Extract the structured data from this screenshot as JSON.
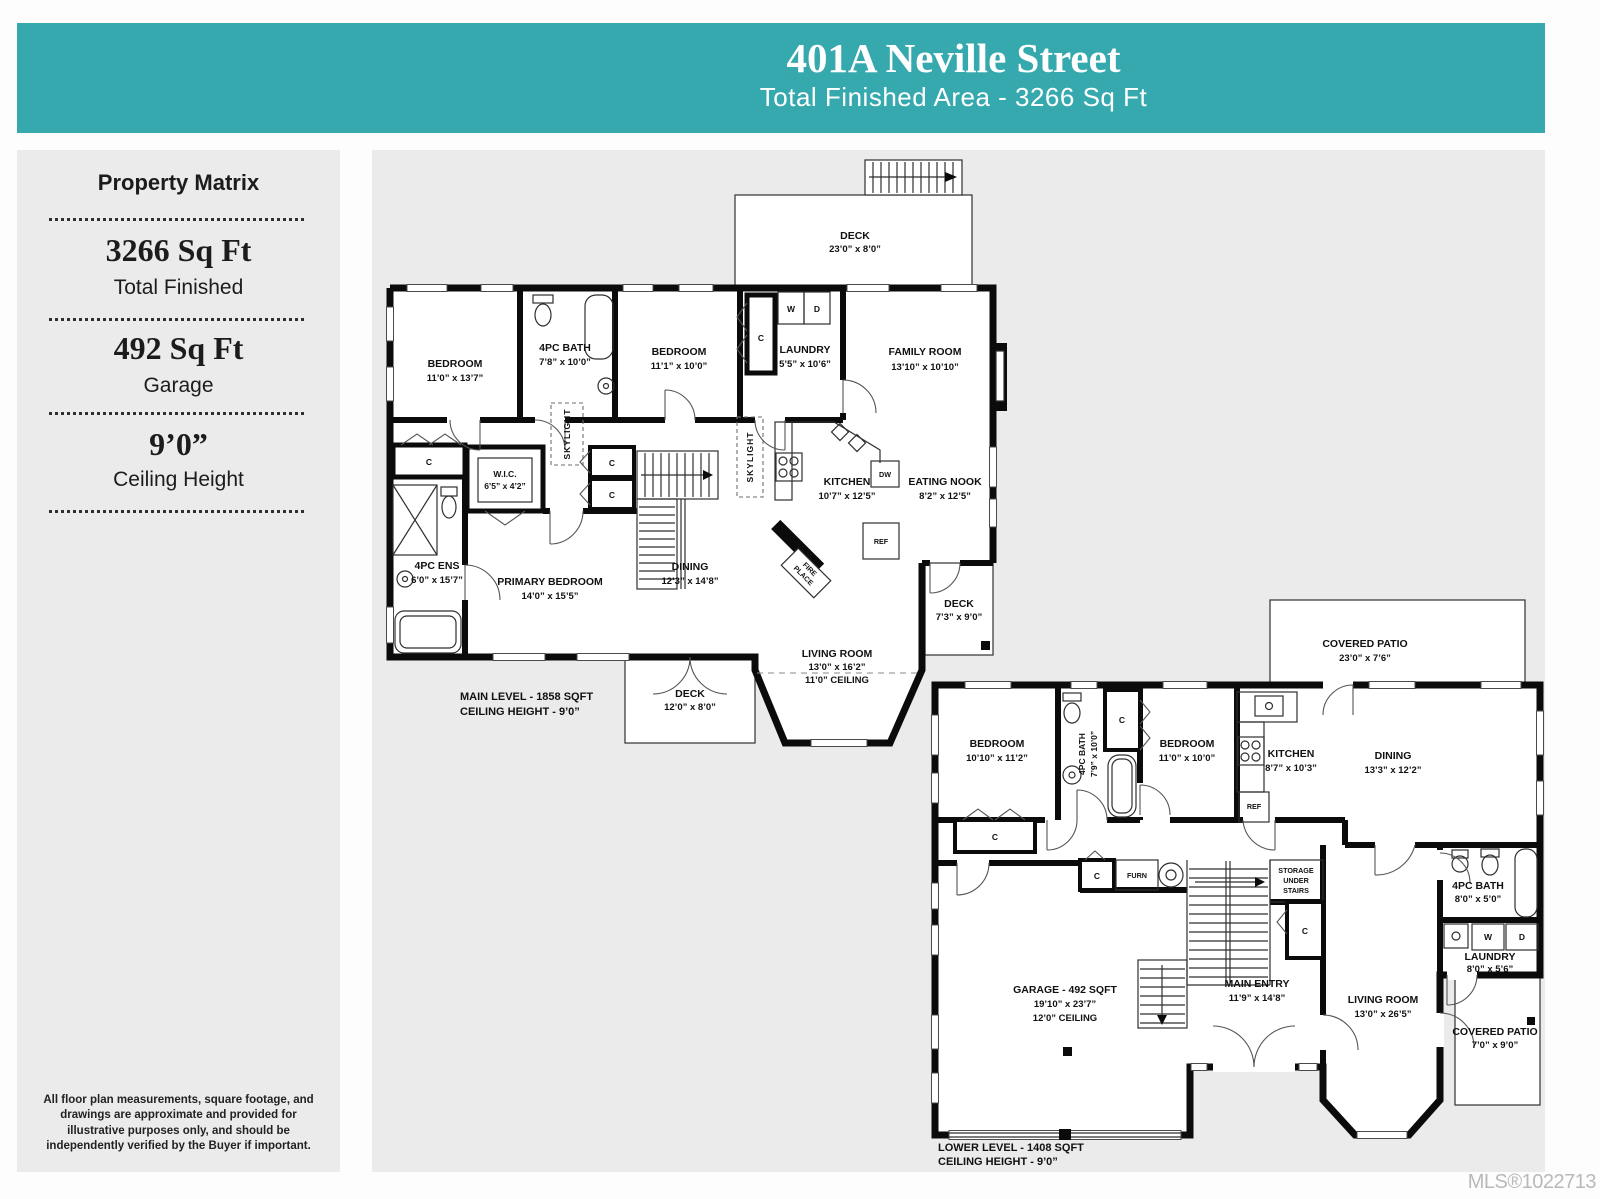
{
  "colors": {
    "header_bg": "#35a9ad",
    "panel_bg": "#ebebeb",
    "wall": "#0b0b0b"
  },
  "header": {
    "title": "401A Neville Street",
    "subtitle": "Total Finished Area - 3266 Sq Ft"
  },
  "sidebar": {
    "title": "Property Matrix",
    "stats": [
      {
        "value": "3266 Sq Ft",
        "label": "Total Finished"
      },
      {
        "value": "492 Sq Ft",
        "label": "Garage"
      },
      {
        "value": "9’0”",
        "label": "Ceiling Height"
      }
    ],
    "disclaimer": "All floor plan measurements, square footage, and drawings are approximate and provided for illustrative purposes only, and should be independently verified by the Buyer if important."
  },
  "tags": {
    "c": "C",
    "w": "W",
    "d": "D",
    "dw": "DW",
    "ref": "REF",
    "furn": "FURN",
    "skylight": "SKYLIGHT",
    "fire": "FIRE",
    "place": "PLACE"
  },
  "main_level": {
    "footer1": "MAIN LEVEL - 1858 SQFT",
    "footer2": "CEILING HEIGHT - 9’0”",
    "rooms": {
      "bedroom1": {
        "name": "BEDROOM",
        "dims": "11’0” x 13’7”"
      },
      "bath": {
        "name": "4PC BATH",
        "dims": "7’8” x 10’0”"
      },
      "bedroom2": {
        "name": "BEDROOM",
        "dims": "11’1” x 10’0”"
      },
      "laundry": {
        "name": "LAUNDRY",
        "dims": "5’5” x 10’6”"
      },
      "family": {
        "name": "FAMILY ROOM",
        "dims": "13’10” x 10’10”"
      },
      "deck_top": {
        "name": "DECK",
        "dims": "23’0” x 8’0”"
      },
      "kitchen": {
        "name": "KITCHEN",
        "dims": "10’7” x 12’5”"
      },
      "nook": {
        "name": "EATING NOOK",
        "dims": "8’2” x 12’5”"
      },
      "wic": {
        "name": "W.I.C.",
        "dims": "6’5” x 4’2”"
      },
      "ens": {
        "name": "4PC ENS",
        "dims": "6’0” x 15’7”"
      },
      "primary": {
        "name": "PRIMARY BEDROOM",
        "dims": "14’0” x 15’5”"
      },
      "dining": {
        "name": "DINING",
        "dims": "12’3” x 14’8”"
      },
      "living": {
        "name": "LIVING ROOM",
        "dims": "13’0” x 16’2”",
        "extra": "11’0” CEILING"
      },
      "deck_right": {
        "name": "DECK",
        "dims": "7’3” x 9’0”"
      },
      "deck_bottom": {
        "name": "DECK",
        "dims": "12’0” x 8’0”"
      }
    }
  },
  "lower_level": {
    "footer1": "LOWER LEVEL - 1408 SQFT",
    "footer2": "CEILING HEIGHT - 9’0”",
    "rooms": {
      "patio_top": {
        "name": "COVERED PATIO",
        "dims": "23’0” x 7’6”"
      },
      "bedroom1": {
        "name": "BEDROOM",
        "dims": "10’10” x 11’2”"
      },
      "bath": {
        "name": "4PC BATH",
        "dims": "7’9” x 10’0”"
      },
      "bedroom2": {
        "name": "BEDROOM",
        "dims": "11’0” x 10’0”"
      },
      "kitchen": {
        "name": "KITCHEN",
        "dims": "8’7” x 10’3”"
      },
      "dining": {
        "name": "DINING",
        "dims": "13’3” x 12’2”"
      },
      "storage": [
        "STORAGE",
        "UNDER",
        "STAIRS"
      ],
      "entry": {
        "name": "MAIN ENTRY",
        "dims": "11’9” x 14’8”"
      },
      "garage": {
        "name": "GARAGE - 492 SQFT",
        "dims": "19’10” x 23’7”",
        "extra": "12’0” CEILING"
      },
      "living": {
        "name": "LIVING ROOM",
        "dims": "13’0” x 26’5”"
      },
      "bath2": {
        "name": "4PC BATH",
        "dims": "8’0” x 5’0”"
      },
      "laundry": {
        "name": "LAUNDRY",
        "dims": "8’0” x 5’6”"
      },
      "patio_br": {
        "name": "COVERED PATIO",
        "dims": "7’0” x 9’0”"
      }
    }
  },
  "mls": "MLS®1022713"
}
